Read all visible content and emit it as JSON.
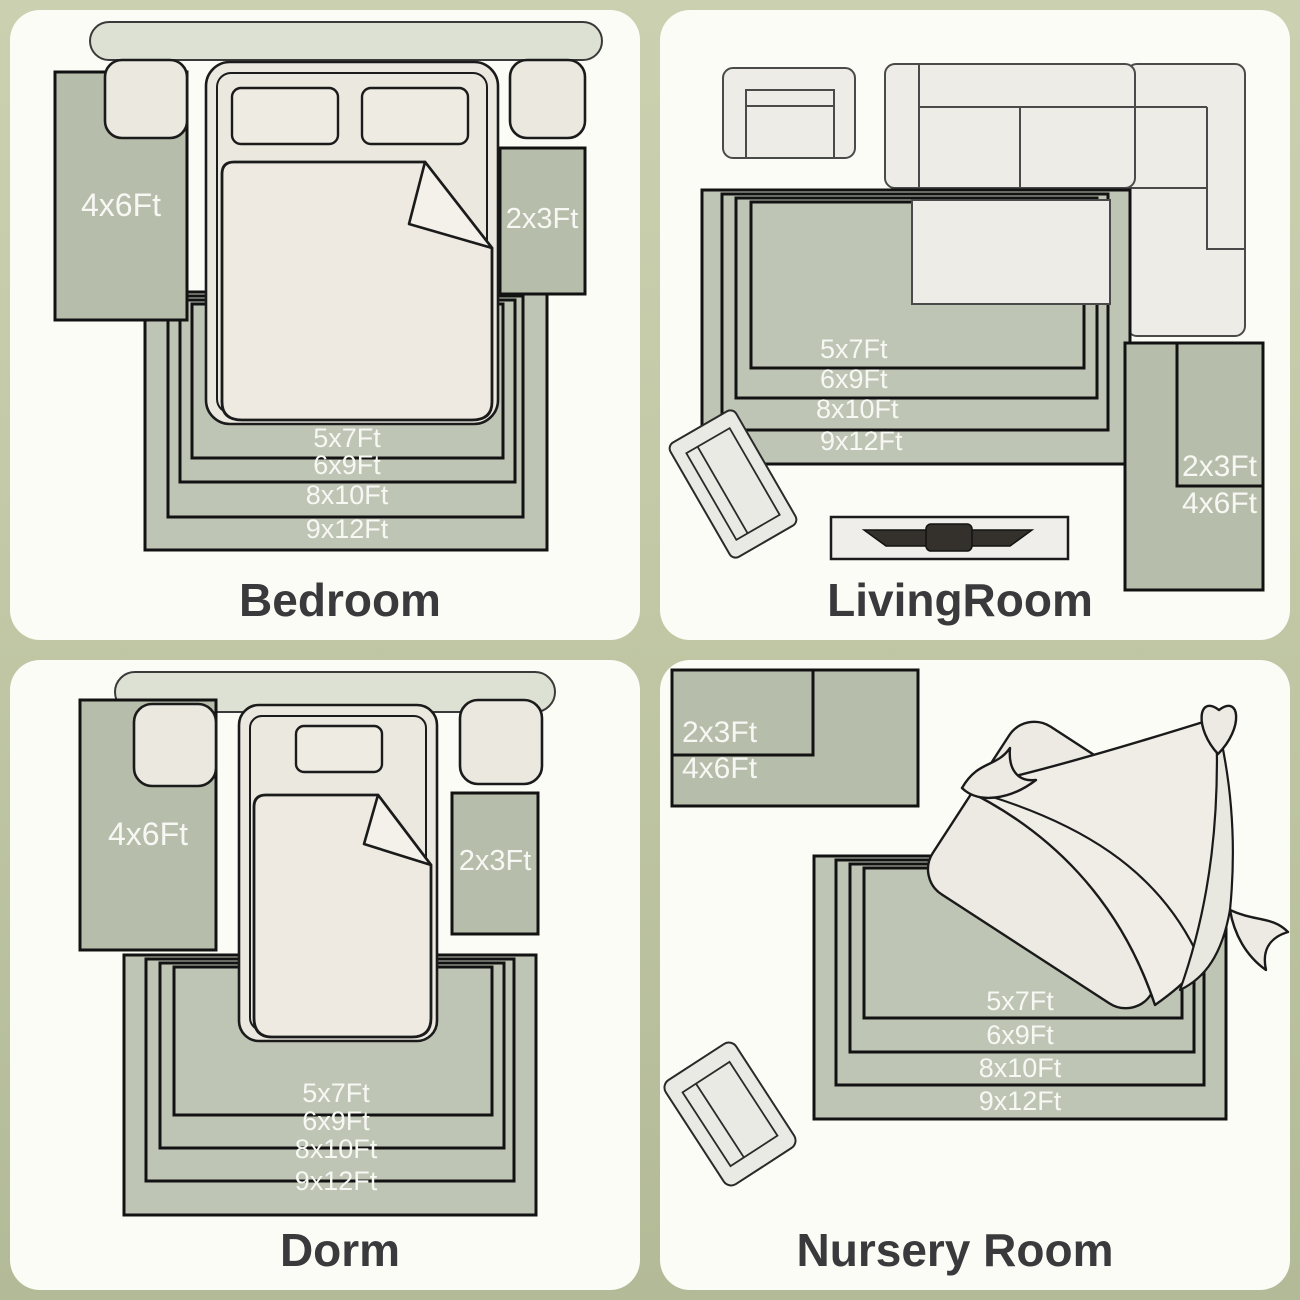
{
  "colors": {
    "page_background_top": "#cbd1b0",
    "page_background_bottom": "#b3ba97",
    "card_background": "#fcfcf7",
    "nested_rug_green": "#bfc5b5",
    "side_rug_green": "#b6bdaa",
    "furniture_fill": "#ebe8e0",
    "outline_dark": "#121212",
    "rug_label_text": "#f7f7f3",
    "title_text": "#3a3a3c",
    "tv_dark": "#34312c"
  },
  "panels": [
    {
      "id": "bedroom",
      "title": "Bedroom",
      "left_rug_label": "4x6Ft",
      "right_rug_label": "2x3Ft",
      "nested_rug_labels": [
        "5x7Ft",
        "6x9Ft",
        "8x10Ft",
        "9x12Ft"
      ]
    },
    {
      "id": "living-room",
      "title": "LivingRoom",
      "combo_inner_label": "2x3Ft",
      "combo_outer_label": "4x6Ft",
      "nested_rug_labels": [
        "5x7Ft",
        "6x9Ft",
        "8x10Ft",
        "9x12Ft"
      ]
    },
    {
      "id": "dorm",
      "title": "Dorm",
      "left_rug_label": "4x6Ft",
      "right_rug_label": "2x3Ft",
      "nested_rug_labels": [
        "5x7Ft",
        "6x9Ft",
        "8x10Ft",
        "9x12Ft"
      ]
    },
    {
      "id": "nursery-room",
      "title": "Nursery Room",
      "combo_inner_label": "2x3Ft",
      "combo_outer_label": "4x6Ft",
      "nested_rug_labels": [
        "5x7Ft",
        "6x9Ft",
        "8x10Ft",
        "9x12Ft"
      ]
    }
  ]
}
